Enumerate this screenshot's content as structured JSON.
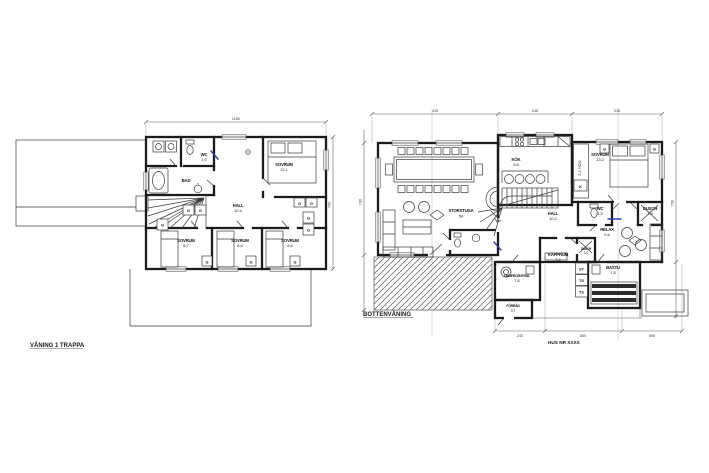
{
  "document": {
    "background": "#ffffff",
    "ink_color": "#1b1b1b",
    "pen_annotation_color": "#2a3fae"
  },
  "captions": {
    "left_plan": "VÅNING 1 TRAPPA",
    "right_plan": "BOTTENVÅNING",
    "house_id": "HUS NR XXXX"
  },
  "left_plan": {
    "rooms": {
      "wc": {
        "name": "WC",
        "area": "2,0"
      },
      "bad": {
        "name": "BAD"
      },
      "hall": {
        "name": "HALL",
        "area": "10,4"
      },
      "sovrum_master": {
        "name": "SOVRUM",
        "area": "12,1"
      },
      "sovrum_2": {
        "name": "SOVRUM",
        "area": "8,7"
      },
      "sovrum_3": {
        "name": "SOVRUM",
        "area": "8,6"
      },
      "sovrum_4": {
        "name": "SOVRUM",
        "area": "8,5"
      }
    },
    "wardrobe_marker": "G",
    "dims": {
      "top": "1180",
      "right": "790"
    }
  },
  "right_plan": {
    "rooms": {
      "storstuga": {
        "name": "STORSTUGA",
        "area": "54"
      },
      "kok": {
        "name": "KÖK",
        "area": "9,8"
      },
      "hall": {
        "name": "HALL",
        "area": "10,2"
      },
      "sovrum": {
        "name": "SOVRUM",
        "area": "13,2"
      },
      "wc": {
        "name": "WC",
        "area": "1,9"
      },
      "dusch_1": {
        "name": "DUSCH",
        "area": "1,9"
      },
      "relax": {
        "name": "RELAX",
        "area": "9,6"
      },
      "kapprum": {
        "name": "KAPPRUM",
        "area": "7,4"
      },
      "dusch_2": {
        "name": "DUSCH",
        "area": "3,0"
      },
      "bastu": {
        "name": "BASTU",
        "area": "7,5"
      },
      "undercentral": {
        "name": "UNDERCENTRAL",
        "area": "7,6"
      },
      "forrad": {
        "name": "FÖRRÅD",
        "area": "3,2"
      }
    },
    "closet_height_note": "2,4 HÖG",
    "closet_small_marker": "K",
    "closet_markers": [
      "ST",
      "TS",
      "TS"
    ],
    "wardrobe_marker": "G",
    "dims": {
      "top": [
        "415",
        "248",
        "318"
      ],
      "left": "730",
      "right": "790",
      "bottom": [
        "240",
        "360",
        "590"
      ]
    }
  }
}
